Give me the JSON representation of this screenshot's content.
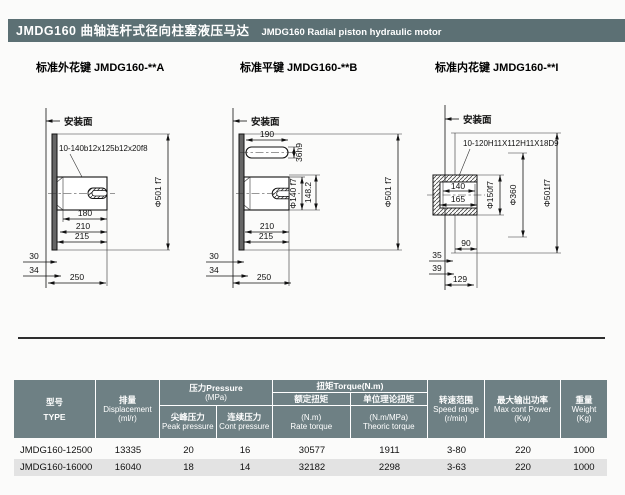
{
  "header": {
    "title_cn": "JMDG160 曲轴连杆式径向柱塞液压马达",
    "title_en": "JMDG160 Radial piston hydraulic motor"
  },
  "drawings": {
    "a": {
      "title": "标准外花键 JMDG160-**A",
      "mount": "安装面",
      "spline": "10-140b12x125b12x20f8",
      "d501": "Φ501 f7",
      "d180": "180",
      "d210": "210",
      "d215": "215",
      "d30": "30",
      "d34": "34",
      "d250": "250"
    },
    "b": {
      "title": "标准平键 JMDG160-**B",
      "mount": "安装面",
      "d190": "190",
      "d36h9": "36h9",
      "d140": "Φ140 f7",
      "d148": "148.2",
      "d501": "Φ501 f7",
      "d210": "210",
      "d215": "215",
      "d30": "30",
      "d34": "34",
      "d250": "250"
    },
    "c": {
      "title": "标准内花键 JMDG160-**I",
      "mount": "安装面",
      "spline": "10-120H11X112H11X18D9",
      "d140": "140",
      "d165": "165",
      "d150": "Φ150f7",
      "d360": "Φ360",
      "d501": "Φ501f7",
      "d90": "90",
      "d35": "35",
      "d39": "39",
      "d129": "129"
    }
  },
  "table": {
    "header": {
      "type_cn": "型号",
      "type_en": "TYPE",
      "disp_cn": "排量",
      "disp_en": "Displacement",
      "disp_unit": "(ml/r)",
      "pressure_cn": "压力Pressure",
      "pressure_unit": "(MPa)",
      "peak_cn": "尖峰压力",
      "peak_en": "Peak pressure",
      "cont_cn": "连续压力",
      "cont_en": "Cont pressure",
      "torque": "扭矩Torque(N.m)",
      "rate_cn": "额定扭矩",
      "rate_unit": "(N.m)",
      "rate_en": "Rate torque",
      "theoric_cn": "单位理论扭矩",
      "theoric_unit": "(N.m/MPa)",
      "theoric_en": "Theoric torque",
      "speed_cn": "转速范围",
      "speed_en": "Speed range",
      "speed_unit": "(r/min)",
      "power_cn": "最大输出功率",
      "power_en": "Max cont Power",
      "power_unit": "(Kw)",
      "weight_cn": "重量",
      "weight_en": "Weight",
      "weight_unit": "(Kg)"
    },
    "rows": [
      {
        "type": "JMDG160-12500",
        "disp": "13335",
        "peak": "20",
        "cont": "16",
        "rate": "30577",
        "theoric": "1911",
        "speed": "3-80",
        "power": "220",
        "weight": "1000"
      },
      {
        "type": "JMDG160-16000",
        "disp": "16040",
        "peak": "18",
        "cont": "14",
        "rate": "32182",
        "theoric": "2298",
        "speed": "3-63",
        "power": "220",
        "weight": "1000"
      }
    ]
  },
  "colors": {
    "titlebar_bg": "#5c7074",
    "table_header_bg": "#6e8084",
    "row_alt_bg": "#e3e3e3"
  }
}
